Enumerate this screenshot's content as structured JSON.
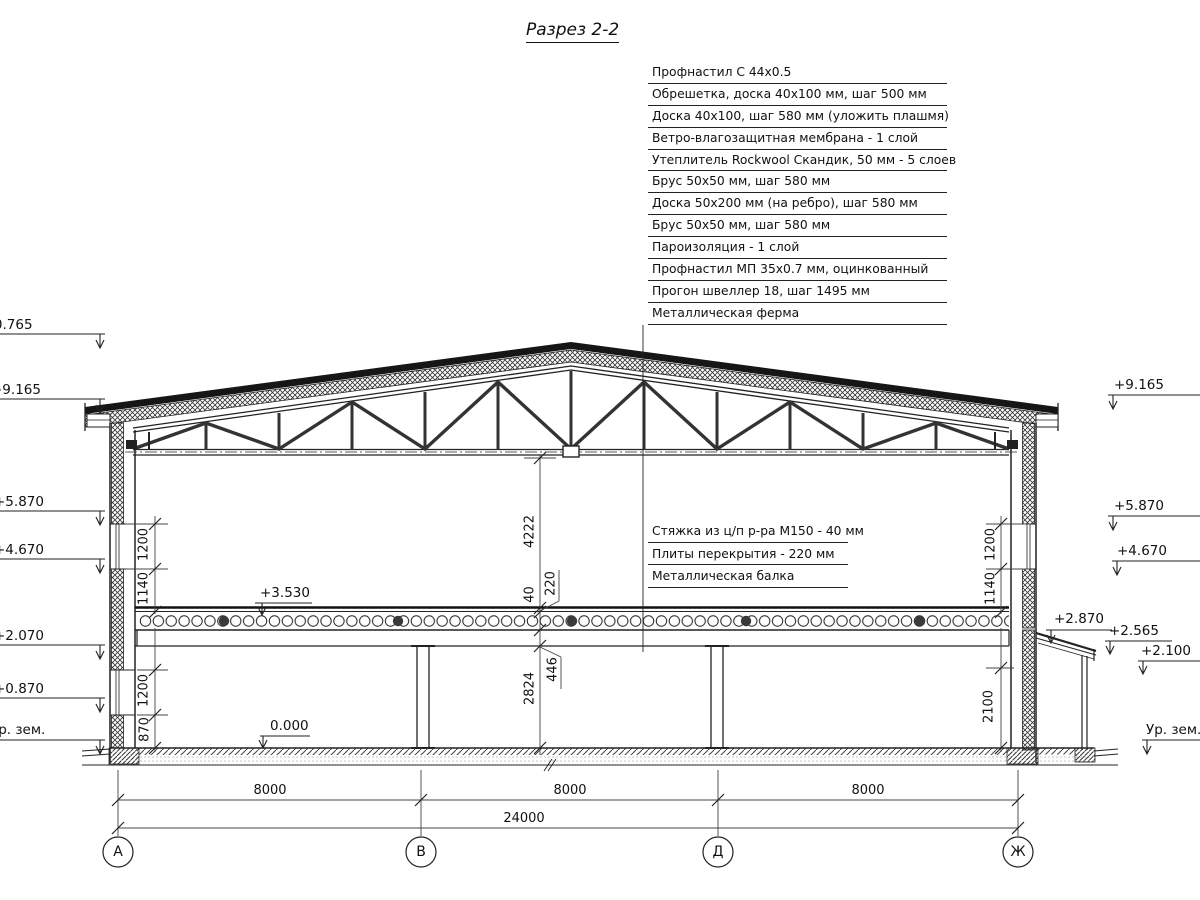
{
  "title": "Разрез 2-2",
  "roof_callouts": [
    "Профнастил С 44х0.5",
    "Обрешетка, доска 40х100 мм, шаг 500 мм",
    "Доска 40х100, шаг 580 мм (уложить плашмя)",
    "Ветро-влагозащитная мембрана - 1 слой",
    "Утеплитель Rockwool Скандик, 50 мм - 5 слоев",
    "Брус 50х50 мм, шаг 580 мм",
    "Доска 50х200 мм (на ребро), шаг 580 мм",
    "Брус 50х50 мм, шаг 580 мм",
    "Пароизоляция - 1 слой",
    "Профнастил МП 35х0.7 мм, оцинкованный",
    "Прогон швеллер 18, шаг 1495 мм",
    "Металлическая ферма"
  ],
  "floor_callouts": [
    "Стяжка из ц/п р-ра М150 - 40 мм",
    "Плиты перекрытия - 220 мм",
    "Металлическая балка"
  ],
  "elevations": {
    "left": [
      "+10.765",
      "+9.165",
      "+5.870",
      "+4.670",
      "+2.070",
      "+0.870",
      "Ур. зем."
    ],
    "right": [
      "+9.165",
      "+5.870",
      "+4.670",
      "+2.870",
      "+2.565",
      "+2.100",
      "Ур. зем."
    ],
    "interior": [
      "+3.530",
      "0.000"
    ]
  },
  "dimensions": {
    "vertical_center": [
      "4222",
      "40",
      "220",
      "446",
      "2824"
    ],
    "vertical_left": [
      "1200",
      "1140",
      "1200",
      "870"
    ],
    "vertical_right": [
      "1200",
      "1140",
      "2100"
    ],
    "horizontal_spans": [
      "8000",
      "8000",
      "8000"
    ],
    "horizontal_total": "24000"
  },
  "axes": [
    "А",
    "В",
    "Д",
    "Ж"
  ]
}
